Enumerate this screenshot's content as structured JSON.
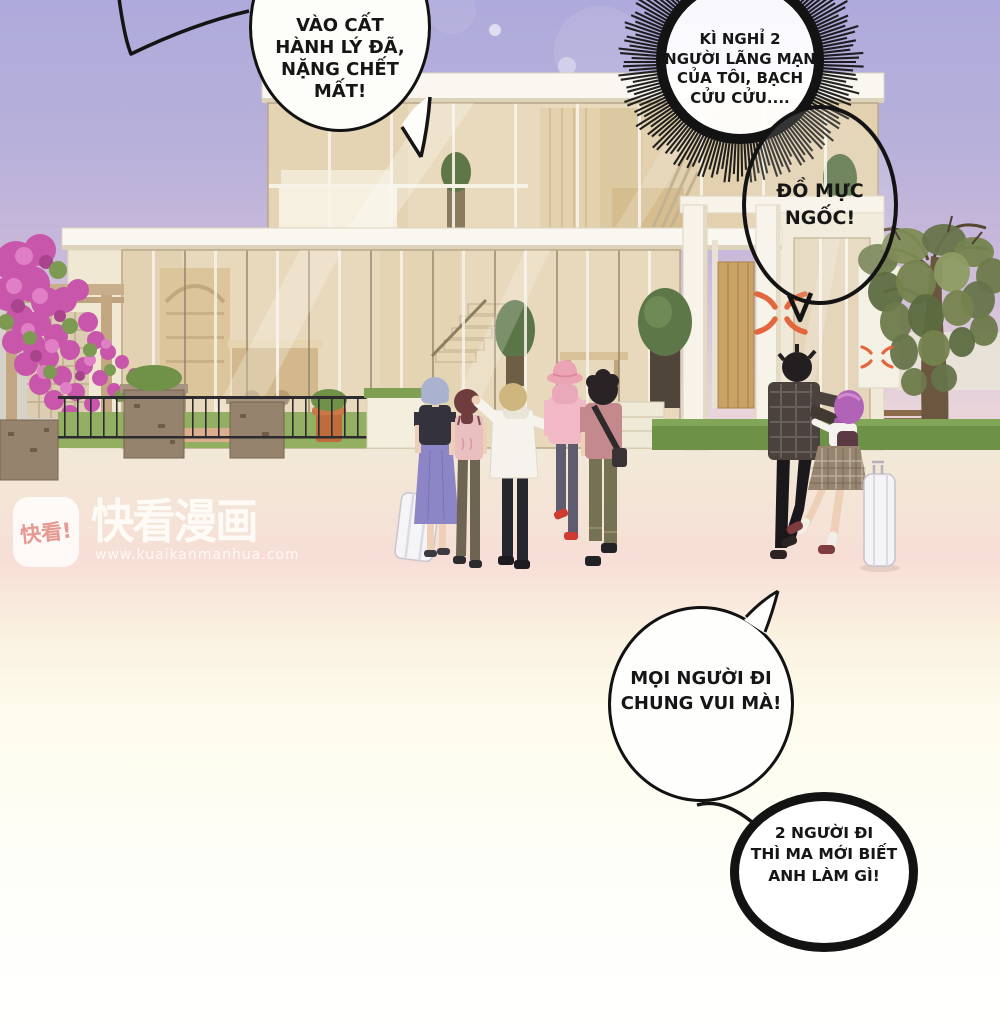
{
  "panel": {
    "type": "webtoon-manga-panel",
    "width": 1000,
    "height": 1034
  },
  "bubbles": [
    {
      "name": "speech-bubble-luggage",
      "shape": "oval",
      "tail": "bottom-and-upper-left",
      "text": "VÀO CẤT HÀNH LÝ ĐÃ, NẶNG CHẾT MẤT!",
      "lines": [
        "VÀO CẤT",
        "HÀNH LÝ ĐÃ,",
        "NẶNG CHẾT",
        "MẤT!"
      ]
    },
    {
      "name": "burst-bubble-vacation",
      "shape": "spiky-burst",
      "text": "KÌ NGHỈ 2 NGƯỜI LÃNG MẠN CỦA TÔI, BẠCH CỬU CỬU....",
      "lines": [
        "KÌ NGHỈ 2",
        "NGƯỜI LÃNG MẠN",
        "CỦA TÔI, BẠCH",
        "CỬU CỬU...."
      ]
    },
    {
      "name": "speech-bubble-insult",
      "shape": "oval-transparent",
      "tail": "bottom-v",
      "text": "ĐỒ MỰC NGỐC!",
      "lines": [
        "ĐỒ MỰC",
        "NGỐC!"
      ]
    },
    {
      "name": "speech-bubble-invite",
      "shape": "oval",
      "tail": "top-right",
      "text": "MỌI NGƯỜI ĐI CHUNG VUI MÀ!",
      "lines": [
        "MỌI NGƯỜI ĐI",
        "CHUNG VUI MÀ!"
      ]
    },
    {
      "name": "burst-bubble-retort",
      "shape": "spiky-burst",
      "text": "2 NGƯỜI ĐI THÌ MA MỚI BIẾT ANH LÀM GÌ!",
      "lines": [
        "2 NGƯỜI ĐI",
        "THÌ MA MỚI BIẾT",
        "ANH LÀM GÌ!"
      ]
    }
  ],
  "watermark": {
    "logo_text": "快看!",
    "brand": "快看漫画",
    "url": "www.kuaikanmanhua.com"
  },
  "colors": {
    "sky_top": "#aeaadb",
    "sky_horizon": "#efdbd9",
    "ground_cream": "#f2e9d8",
    "pink_band": "#f7ded6",
    "bubble_outline": "#141414",
    "anger_mark": "#e2663e",
    "flowers": "#c857ab",
    "lawn": "#93b062",
    "villa_interior": "#e8d9bc",
    "girl_purple_hair": "#b163b8"
  },
  "scene": {
    "setting": "modern two-story glass villa with garden at dusk",
    "characters": [
      "girl-grey-bob-purple-skirt",
      "girl-auburn-pink-top",
      "boy-blonde-white-hoodie",
      "girl-pink-hat",
      "boy-black-hair-crossbody-bag",
      "man-plaid-jacket-grabbing",
      "girl-purple-hair-plaid-skirt"
    ],
    "props": [
      "rolling-suitcase-left",
      "rolling-suitcase-right",
      "anger-marks",
      "garden-bench",
      "bougainvillea"
    ]
  }
}
